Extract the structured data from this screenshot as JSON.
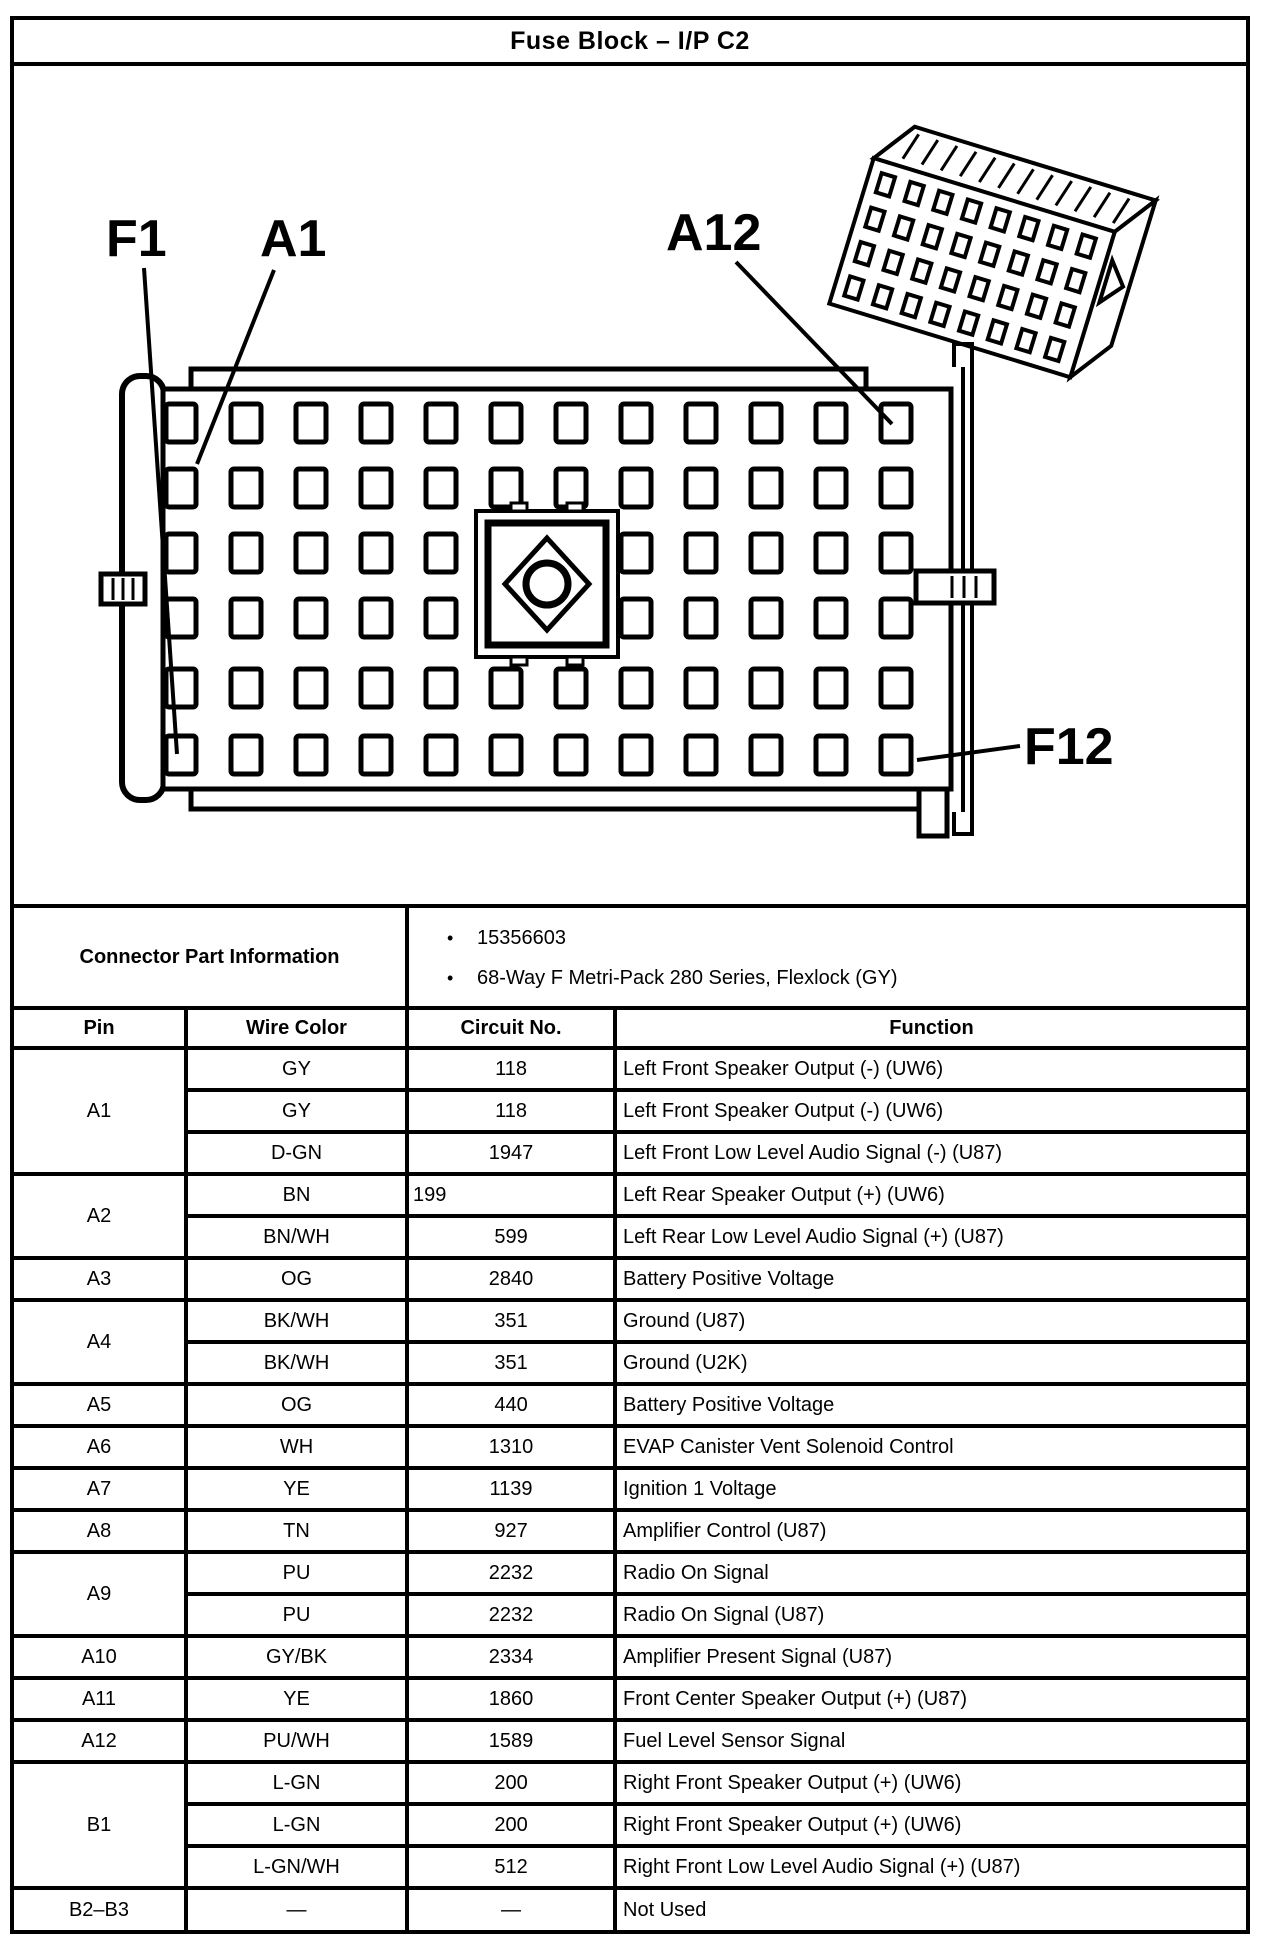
{
  "page": {
    "title": "Fuse Block – I/P C2"
  },
  "colors": {
    "ink": "#000000",
    "paper": "#ffffff"
  },
  "diagram": {
    "labels": {
      "f1": "F1",
      "a1": "A1",
      "a12": "A12",
      "f12": "F12"
    }
  },
  "connector_info": {
    "label": "Connector Part Information",
    "bullet": "•",
    "bullets": [
      "15356603",
      "68-Way F Metri-Pack 280 Series, Flexlock (GY)"
    ]
  },
  "table": {
    "headers": [
      "Pin",
      "Wire Color",
      "Circuit No.",
      "Function"
    ],
    "groups": [
      {
        "pin": "A1",
        "rows": [
          {
            "wire": "GY",
            "circuit": "118",
            "function": "Left Front Speaker Output (-) (UW6)"
          },
          {
            "wire": "GY",
            "circuit": "118",
            "function": "Left Front Speaker Output (-) (UW6)"
          },
          {
            "wire": "D-GN",
            "circuit": "1947",
            "function": "Left Front Low Level Audio Signal (-) (U87)"
          }
        ]
      },
      {
        "pin": "A2",
        "rows": [
          {
            "wire": "BN",
            "circuit": "199",
            "align": "left",
            "function": "Left Rear Speaker Output (+) (UW6)"
          },
          {
            "wire": "BN/WH",
            "circuit": "599",
            "function": "Left Rear Low Level Audio Signal (+) (U87)"
          }
        ]
      },
      {
        "pin": "A3",
        "rows": [
          {
            "wire": "OG",
            "circuit": "2840",
            "function": "Battery Positive Voltage"
          }
        ]
      },
      {
        "pin": "A4",
        "rows": [
          {
            "wire": "BK/WH",
            "circuit": "351",
            "function": "Ground (U87)"
          },
          {
            "wire": "BK/WH",
            "circuit": "351",
            "function": "Ground (U2K)"
          }
        ]
      },
      {
        "pin": "A5",
        "rows": [
          {
            "wire": "OG",
            "circuit": "440",
            "function": "Battery Positive Voltage"
          }
        ]
      },
      {
        "pin": "A6",
        "rows": [
          {
            "wire": "WH",
            "circuit": "1310",
            "function": "EVAP Canister Vent Solenoid Control"
          }
        ]
      },
      {
        "pin": "A7",
        "rows": [
          {
            "wire": "YE",
            "circuit": "1139",
            "function": "Ignition 1 Voltage"
          }
        ]
      },
      {
        "pin": "A8",
        "rows": [
          {
            "wire": "TN",
            "circuit": "927",
            "function": "Amplifier Control (U87)"
          }
        ]
      },
      {
        "pin": "A9",
        "rows": [
          {
            "wire": "PU",
            "circuit": "2232",
            "function": "Radio On Signal"
          },
          {
            "wire": "PU",
            "circuit": "2232",
            "function": "Radio On Signal (U87)"
          }
        ]
      },
      {
        "pin": "A10",
        "rows": [
          {
            "wire": "GY/BK",
            "circuit": "2334",
            "function": "Amplifier Present Signal (U87)"
          }
        ]
      },
      {
        "pin": "A11",
        "rows": [
          {
            "wire": "YE",
            "circuit": "1860",
            "function": "Front Center Speaker Output (+) (U87)"
          }
        ]
      },
      {
        "pin": "A12",
        "rows": [
          {
            "wire": "PU/WH",
            "circuit": "1589",
            "function": "Fuel Level Sensor Signal"
          }
        ]
      },
      {
        "pin": "B1",
        "rows": [
          {
            "wire": "L-GN",
            "circuit": "200",
            "function": "Right Front Speaker Output (+) (UW6)"
          },
          {
            "wire": "L-GN",
            "circuit": "200",
            "function": "Right Front Speaker Output (+) (UW6)"
          },
          {
            "wire": "L-GN/WH",
            "circuit": "512",
            "function": "Right Front Low Level Audio Signal (+) (U87)"
          }
        ]
      },
      {
        "pin": "B2–B3",
        "rows": [
          {
            "wire": "—",
            "circuit": "—",
            "function": "Not Used"
          }
        ]
      }
    ]
  }
}
